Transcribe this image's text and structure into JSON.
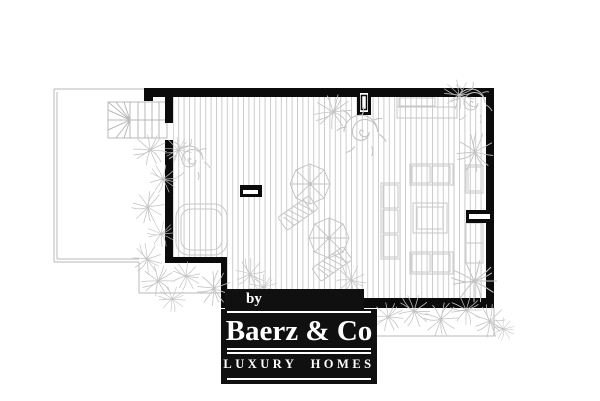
{
  "logo": {
    "by_label": "by",
    "brand_name": "Baerz & Co",
    "tagline": "LUXURY HOMES"
  },
  "icons": {
    "palm": "palm-tree",
    "shrub": "spiral-shrub",
    "parasol": "parasol-top",
    "stairs": "staircase"
  },
  "colors": {
    "wall": "#0b0b0b",
    "hatch_line": "#cccccc",
    "furniture_line": "#c7c7c7",
    "plant_line": "#c3c3c3",
    "boundary_line": "#b9b9b9",
    "logo_bg": "#101010",
    "logo_text": "#ffffff",
    "canvas_bg": "#ffffff"
  }
}
